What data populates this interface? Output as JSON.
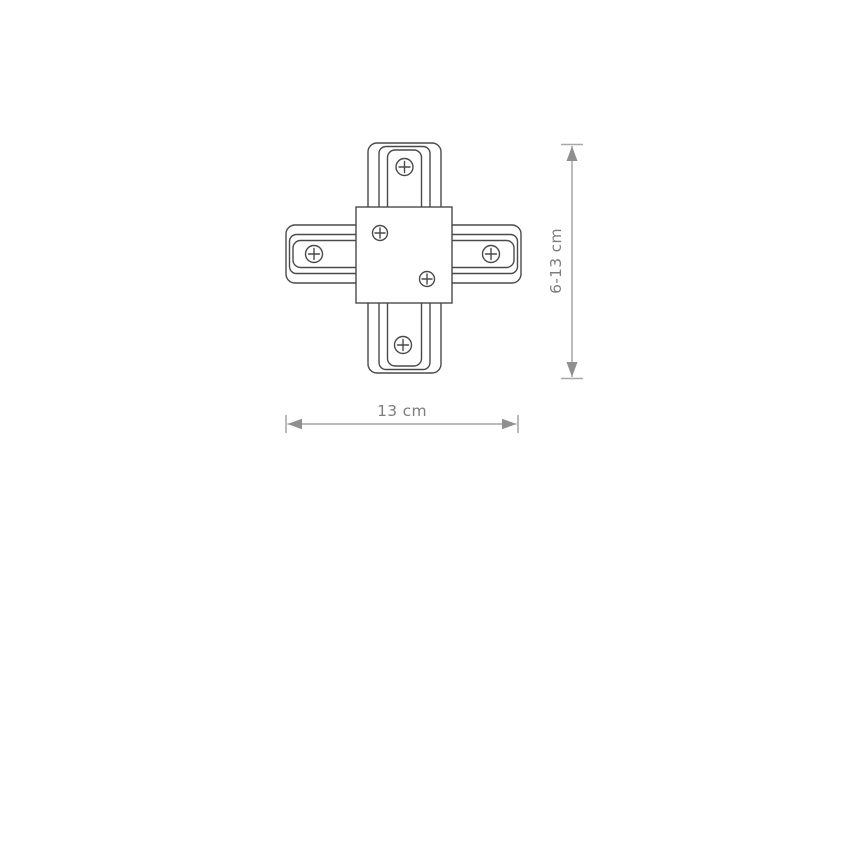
{
  "diagram": {
    "title": "track X-connector technical drawing",
    "dimensions": {
      "width": {
        "label": "13 cm"
      },
      "height": {
        "label": "6-13 cm"
      }
    },
    "icons": {
      "screw": "circle-plus"
    },
    "colors": {
      "background": "#ffffff",
      "outline": "#4a4a4a",
      "fill": "#ffffff",
      "dimension": "#8f8f8f",
      "dimension_cap": "#a8a8a8",
      "dimension_text": "#7d7d7d"
    }
  }
}
